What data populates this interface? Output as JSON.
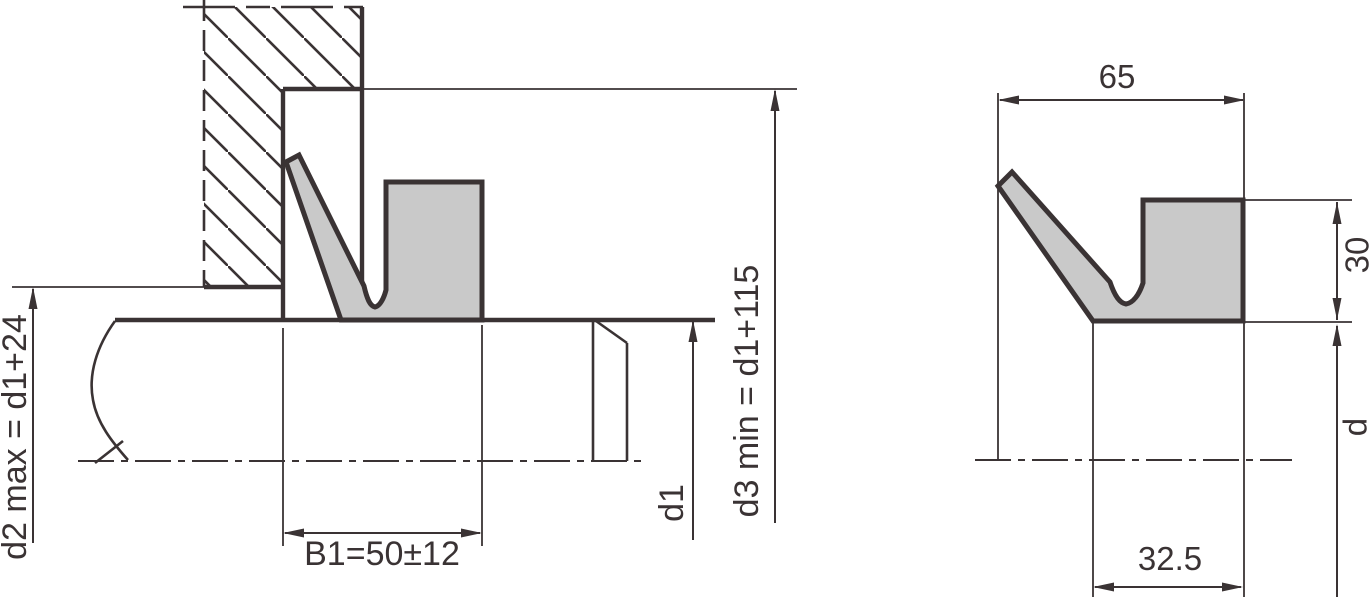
{
  "drawing": {
    "left_view": {
      "labels": {
        "d2": "d2 max = d1+24",
        "b1": "B1=50±12",
        "d1": "d1",
        "d3": "d3 min = d1+115"
      }
    },
    "right_view": {
      "labels": {
        "overall_width": "65",
        "heel_height": "30",
        "inner_width": "32.5",
        "rod_diameter": "d"
      }
    },
    "colors": {
      "line": "#3a3334",
      "seal_fill": "#c9c9c9",
      "background": "#ffffff"
    }
  }
}
